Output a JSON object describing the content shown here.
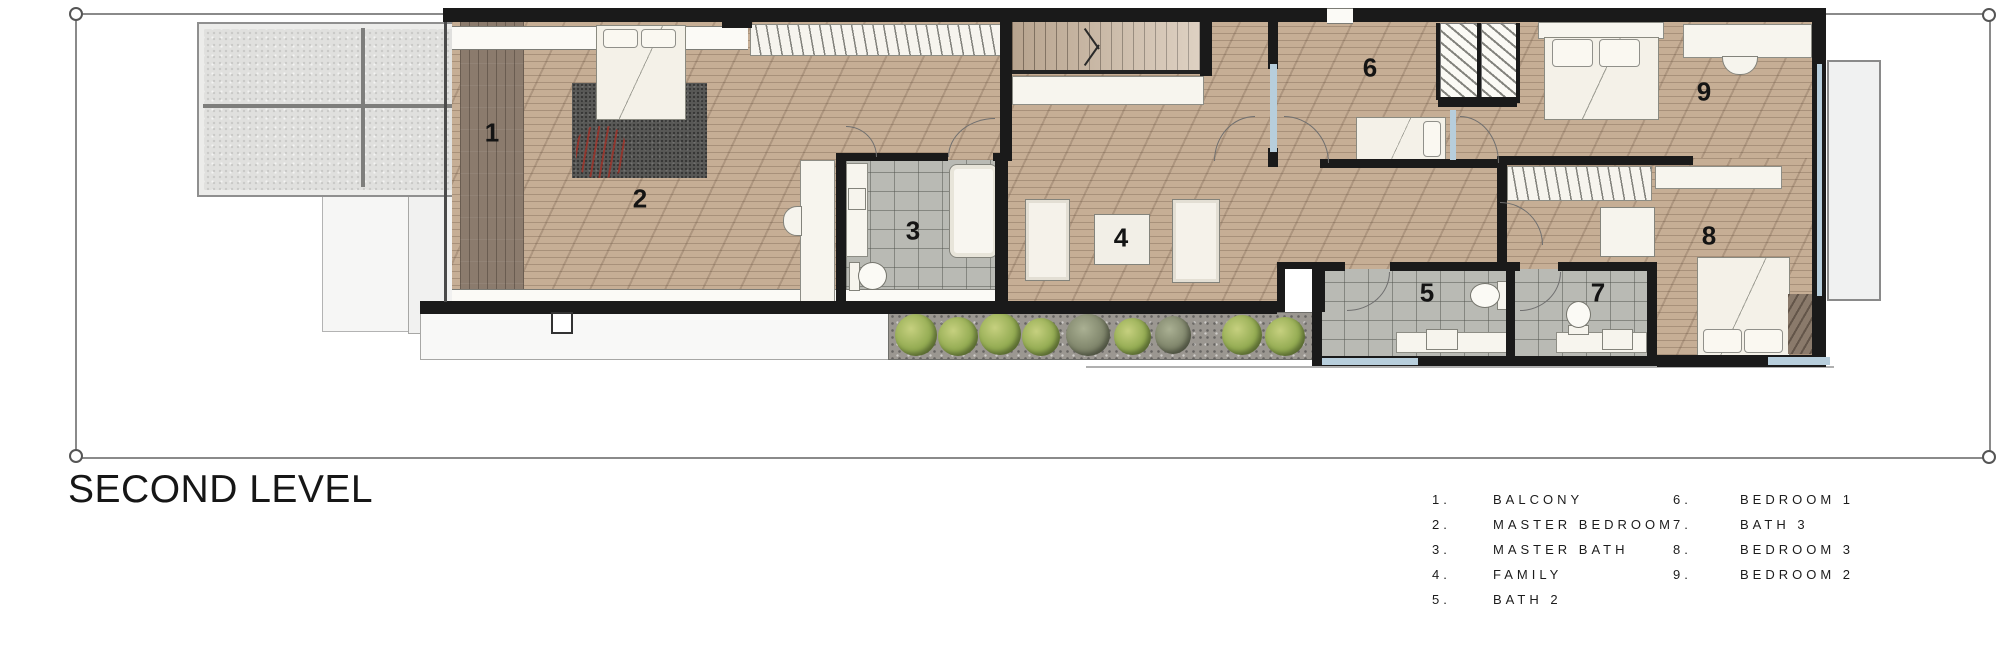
{
  "title": "SECOND LEVEL",
  "rooms": [
    {
      "num": "1",
      "dot": "1.",
      "name": "BALCONY"
    },
    {
      "num": "2",
      "dot": "2.",
      "name": "MASTER BEDROOM"
    },
    {
      "num": "3",
      "dot": "3.",
      "name": "MASTER BATH"
    },
    {
      "num": "4",
      "dot": "4.",
      "name": "FAMILY"
    },
    {
      "num": "5",
      "dot": "5.",
      "name": "BATH 2"
    },
    {
      "num": "6",
      "dot": "6.",
      "name": "BEDROOM 1"
    },
    {
      "num": "7",
      "dot": "7.",
      "name": "BATH 3"
    },
    {
      "num": "8",
      "dot": "8.",
      "name": "BEDROOM 3"
    },
    {
      "num": "9",
      "dot": "9.",
      "name": "BEDROOM 2"
    }
  ],
  "palette": {
    "wood_floor": "#c6ae95",
    "balcony_deck": "#8b7b6d",
    "bath_tile": "#b9bab4",
    "wall_black": "#1a1a1a",
    "glazing_blue": "#b7cedc",
    "shrub_green": "#93ab52",
    "rug_gray": "#585856",
    "plant_red": "#a43026"
  }
}
